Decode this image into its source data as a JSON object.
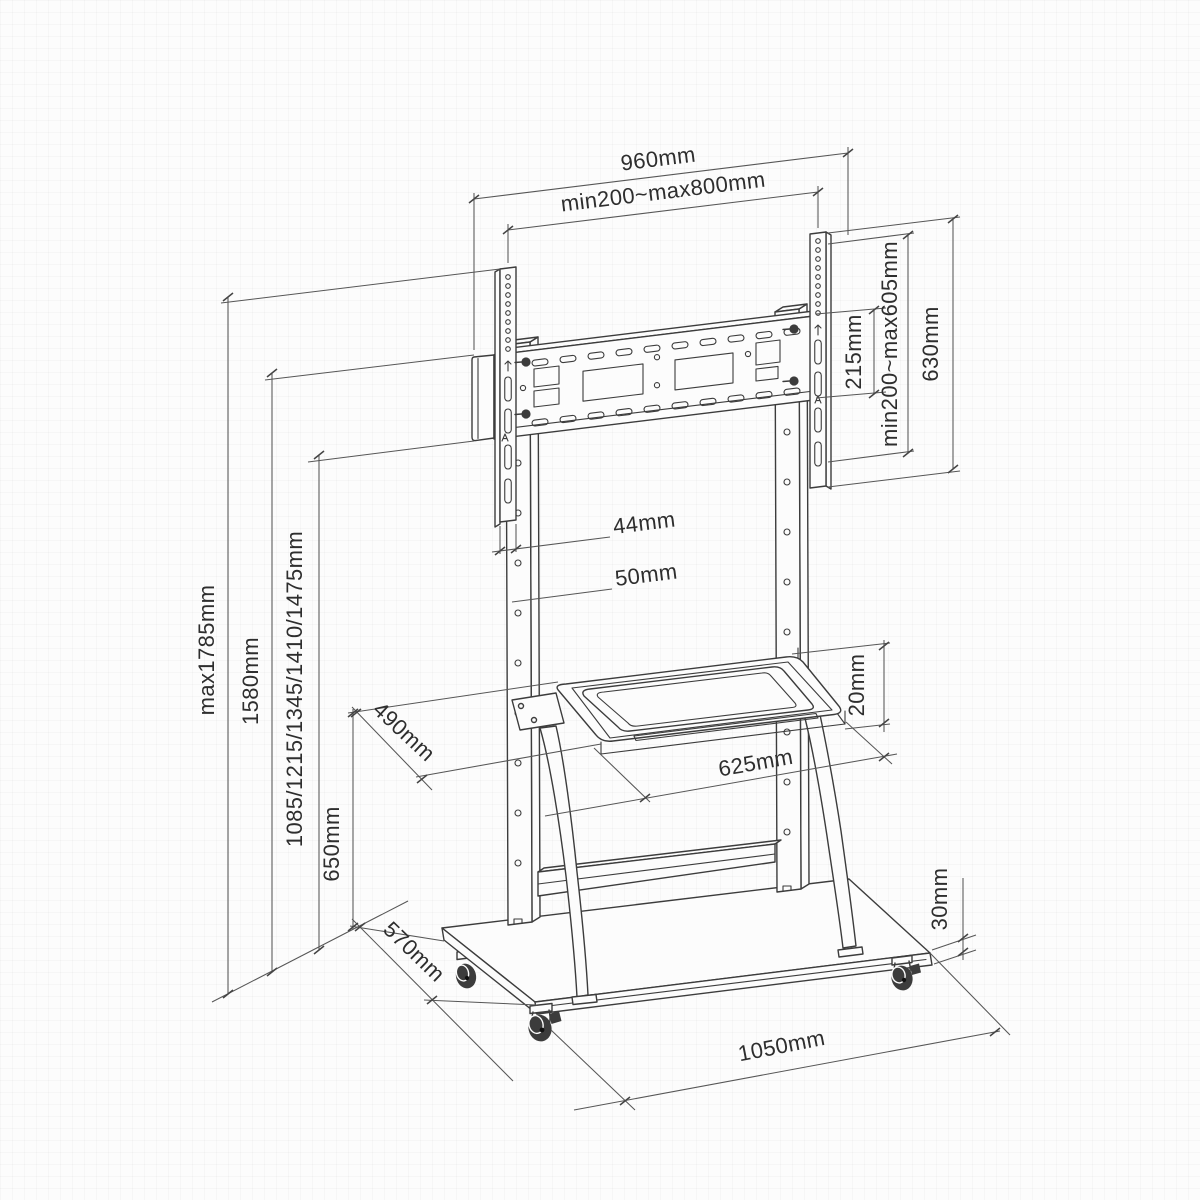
{
  "diagram": {
    "name": "mobile-tv-stand-dimension-drawing",
    "dims": {
      "top_width": "960mm",
      "vesa_width": "min200~max800mm",
      "bracket_height": "215mm",
      "vesa_height": "min200~max605mm",
      "rail_height": "630mm",
      "max_height": "max1785mm",
      "column_height": "1580mm",
      "screen_center_heights": "1085/1215/1345/1410/1475mm",
      "shelf_height": "650mm",
      "rail_width": "44mm",
      "hole_pitch": "50mm",
      "shelf_depth": "490mm",
      "shelf_width": "625mm",
      "shelf_thickness": "20mm",
      "base_depth": "570mm",
      "base_width": "1050mm",
      "base_thickness": "30mm"
    },
    "colors": {
      "line": "#3c3c3c",
      "dim_line": "#565656",
      "text": "#2e2e2e",
      "background": "#fcfcfc"
    }
  }
}
